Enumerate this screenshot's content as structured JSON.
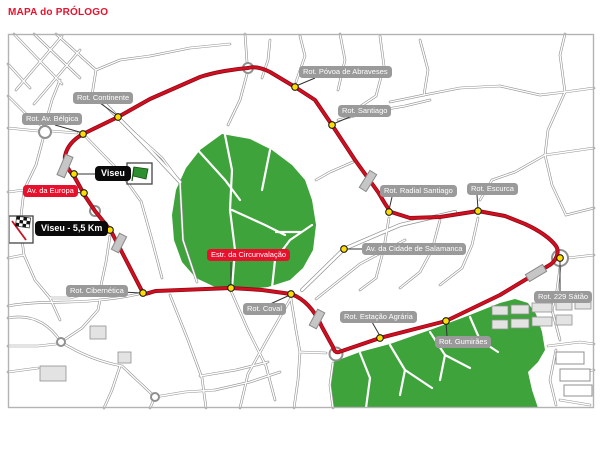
{
  "title": "MAPA do PRÓLOGO",
  "map": {
    "start": {
      "label": "Viseu",
      "icon": "green-flag-icon"
    },
    "finish": {
      "label": "Viseu - 5,5 Km",
      "icon": "checkered-flag-icon"
    },
    "labels": {
      "continente": "Rot. Continente",
      "av_belgica": "Rot. Av. Bélgica",
      "povoa_abraveses": "Rot. Póvoa de Abraveses",
      "santiago": "Rot. Santiago",
      "radial_santiago": "Rot. Radial Santiago",
      "escurca": "Rot. Escurca",
      "cidade_salamanca": "Av. da Cidade de Salamanca",
      "cibernetica": "Rot. Cibernética",
      "coval": "Rot. Coval",
      "estacao_agraria": "Rot. Estação Agrária",
      "gumiraes": "Rot. Gumirães",
      "satao_229": "Rot. 229 Sátão",
      "av_europa": "Av. da Europa",
      "circunvalacao": "Estr. da Circunvalação"
    },
    "colors": {
      "title_red": "#e8112d",
      "route_red": "#d10f21",
      "route_casing": "#8f0a16",
      "marker_yellow": "#ffdd00",
      "park_green": "#3da33a",
      "flag_green": "#2e8f2e",
      "road_gray": "#909090",
      "label_gray_bg": "#9a9a9a",
      "label_red_bg": "#e8112d",
      "label_black_bg": "#0a0a0a",
      "border_gray": "#b3b3b3"
    }
  }
}
